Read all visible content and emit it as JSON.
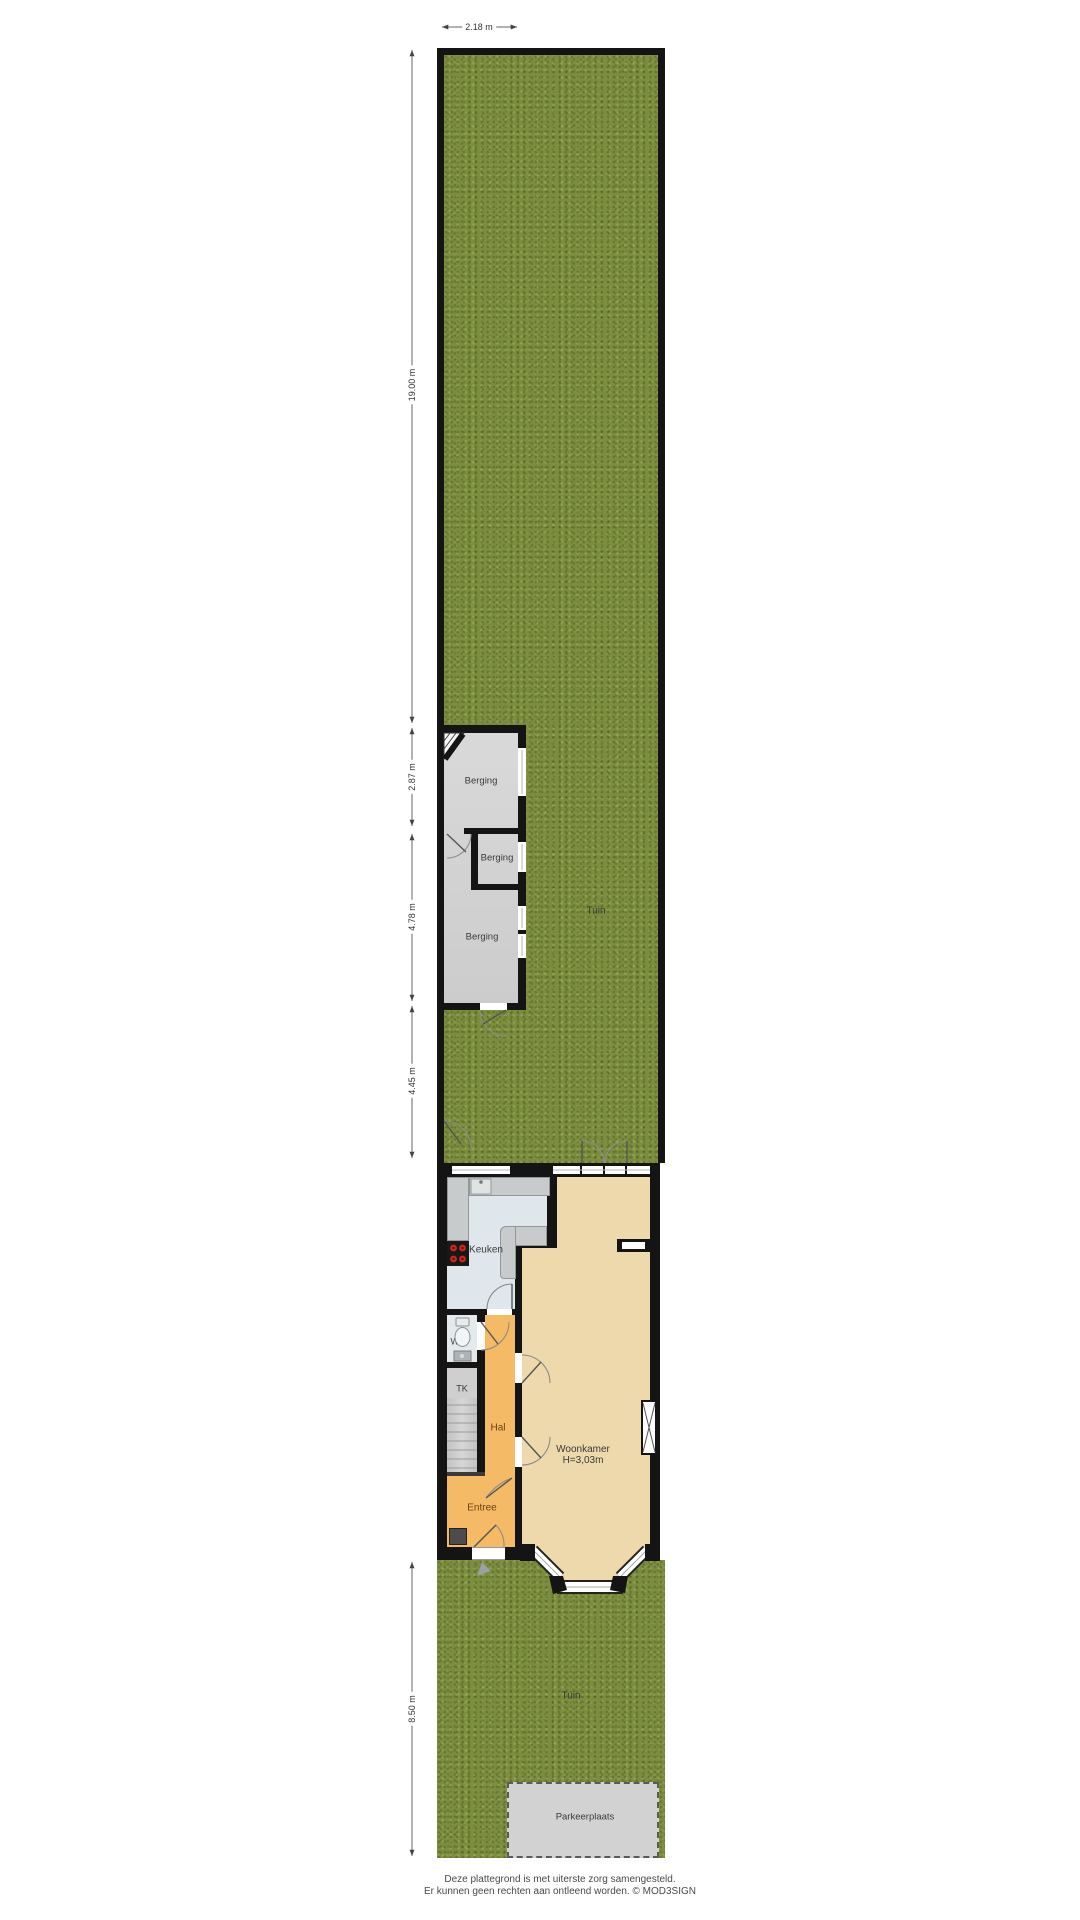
{
  "plan": {
    "dimensions": {
      "top_width": "2.18 m",
      "back_garden_length": "19.00 m",
      "berging_top_length": "2.87 m",
      "berging_bottom_length": "4.78 m",
      "mid_garden_length": "4.45 m",
      "front_garden_length": "8.50 m"
    },
    "rooms": {
      "tuin_back": "Tuin",
      "berging_top": "Berging",
      "berging_small": "Berging",
      "berging_large": "Berging",
      "keuken": "Keuken",
      "wc": "WC",
      "tk": "TK",
      "hal": "Hal",
      "entree": "Entree",
      "woonkamer": "Woonkamer",
      "woonkamer_height": "H=3,03m",
      "tuin_front": "Tuin",
      "parkeerplaats": "Parkeerplaats"
    },
    "footer": {
      "line1": "Deze plattegrond is met uiterste zorg samengesteld.",
      "line2": "Er kunnen geen rechten aan ontleend worden. © MOD3SIGN"
    },
    "colors": {
      "grass": "#7c8e3e",
      "wall": "#141414",
      "outbuilding_floor": "#d4d4d4",
      "kitchen_floor": "#dfe7ec",
      "living_floor": "#edd9ac",
      "hall_floor": "#f5ba65",
      "wc_floor": "#e4eaec",
      "parking": "#d2d2d2",
      "cooktop_burner": "#cc2a18"
    }
  }
}
